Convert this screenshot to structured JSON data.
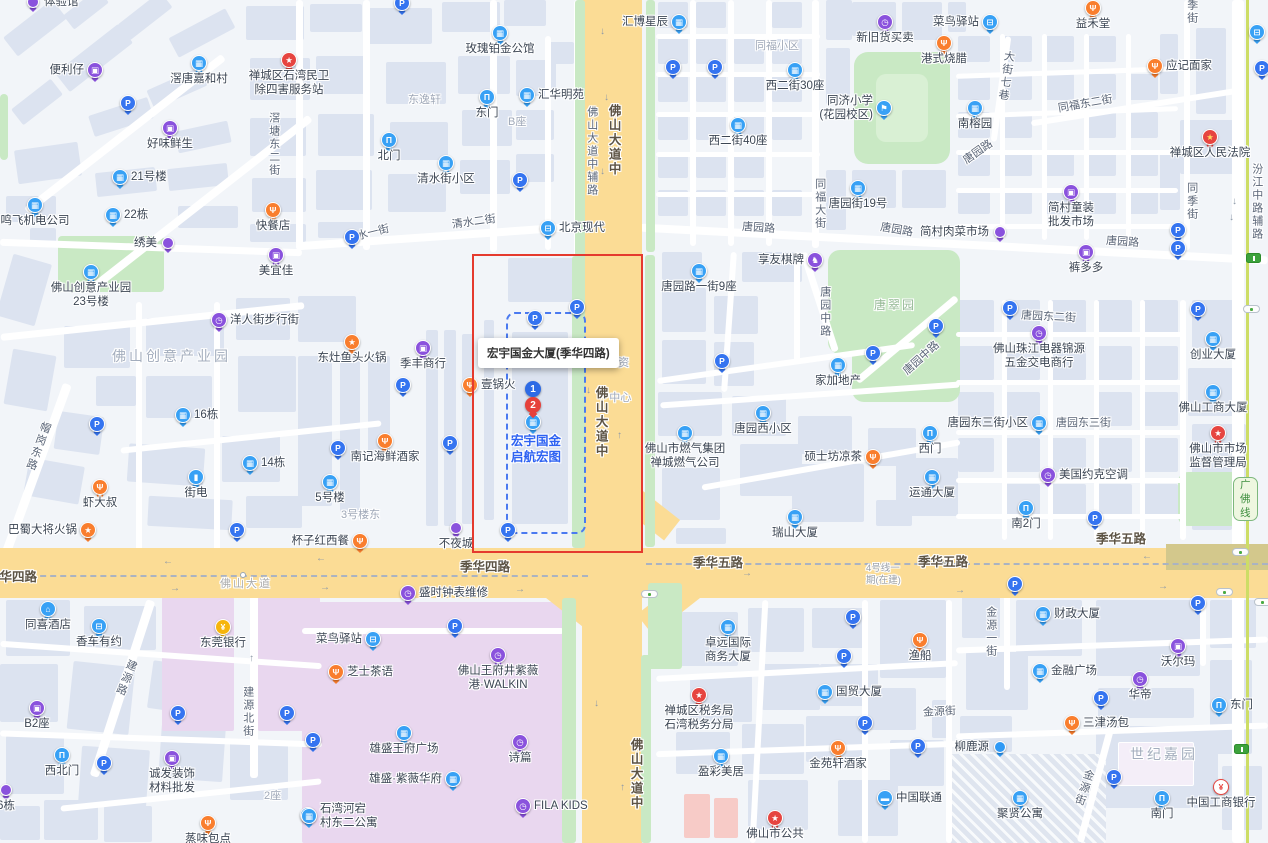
{
  "title": "宏宇国金大厦(季华四路) 地图",
  "colors": {
    "road_major": "#fbdc95",
    "road_minor": "#ffffff",
    "building": "#dce3f0",
    "green": "#c9e9c4",
    "mall": "#e9d7ef",
    "highlight_box": "#e53a2e",
    "parcel_dash": "#4b7af0",
    "poi_blue": "#38a1f5",
    "poi_parking": "#3574f0",
    "poi_purple": "#8a52dd",
    "poi_orange": "#f97e2e",
    "poi_red": "#e64540",
    "poi_yellow": "#f6b50c",
    "metro_line": "#cddd66",
    "poi_title_blue": "#2e62f2"
  },
  "highlight": {
    "box_label": "宏宇国金大厦(季华四路)",
    "marker_1": "1",
    "marker_2": "2",
    "poi_title_line1": "宏宇国金",
    "poi_title_line2": "启航宏图",
    "occluded_line1": "资",
    "occluded_line2": "中心"
  },
  "road_labels": [
    {
      "t": "滘塘东二街",
      "x": 266,
      "y": 112,
      "k": "street",
      "v": 1
    },
    {
      "t": "清水一街",
      "x": 346,
      "y": 228,
      "k": "street",
      "rot": -14
    },
    {
      "t": "清水二街",
      "x": 452,
      "y": 216,
      "k": "street",
      "rot": -8
    },
    {
      "t": "佛山大道中辅路",
      "x": 584,
      "y": 106,
      "k": "street",
      "v": 1
    },
    {
      "t": "佛山大道中",
      "x": 605,
      "y": 104,
      "k": "road",
      "v": 1
    },
    {
      "t": "佛山大道中",
      "x": 592,
      "y": 386,
      "k": "road",
      "v": 1
    },
    {
      "t": "佛山大道中",
      "x": 627,
      "y": 738,
      "k": "road",
      "v": 1
    },
    {
      "t": "东逸轩",
      "x": 408,
      "y": 94,
      "k": "area"
    },
    {
      "t": "B座",
      "x": 508,
      "y": 116,
      "k": "area"
    },
    {
      "t": "同福小区",
      "x": 755,
      "y": 40,
      "k": "area"
    },
    {
      "t": "同福大街",
      "x": 812,
      "y": 178,
      "k": "street",
      "v": 1
    },
    {
      "t": "唐园路",
      "x": 742,
      "y": 222,
      "k": "street",
      "rot": 4
    },
    {
      "t": "唐园路",
      "x": 880,
      "y": 224,
      "k": "street",
      "rot": 10
    },
    {
      "t": "唐园路",
      "x": 962,
      "y": 146,
      "k": "street",
      "rot": -35
    },
    {
      "t": "唐园路",
      "x": 1106,
      "y": 236,
      "k": "street",
      "rot": 4
    },
    {
      "t": "大街七巷",
      "x": 998,
      "y": 50,
      "k": "street",
      "v": 1,
      "rot": 8
    },
    {
      "t": "同福东二街",
      "x": 1058,
      "y": 98,
      "k": "street",
      "rot": -10
    },
    {
      "t": "同季街",
      "x": 1184,
      "y": -14,
      "k": "street",
      "v": 1
    },
    {
      "t": "同季街",
      "x": 1184,
      "y": 182,
      "k": "street",
      "v": 1
    },
    {
      "t": "汾江中路辅路",
      "x": 1249,
      "y": 163,
      "k": "street",
      "v": 1
    },
    {
      "t": "唐园中路",
      "x": 817,
      "y": 286,
      "k": "street",
      "v": 1
    },
    {
      "t": "唐园中路",
      "x": 900,
      "y": 352,
      "k": "street",
      "rot": -42
    },
    {
      "t": "唐翠园",
      "x": 874,
      "y": 298,
      "k": "park"
    },
    {
      "t": "唐园东二街",
      "x": 1021,
      "y": 311,
      "k": "street",
      "rot": 3
    },
    {
      "t": "唐园东三街",
      "x": 1056,
      "y": 417,
      "k": "street"
    },
    {
      "t": "帽岗东路",
      "x": 30,
      "y": 420,
      "k": "street",
      "v": 1,
      "rot": 20
    },
    {
      "t": "佛山创意产业园",
      "x": 112,
      "y": 348,
      "k": "area-lg"
    },
    {
      "t": "3号楼东",
      "x": 341,
      "y": 509,
      "k": "area"
    },
    {
      "t": "季华四路",
      "x": -13,
      "y": 570,
      "k": "road"
    },
    {
      "t": "佛山大道",
      "x": 220,
      "y": 578,
      "k": "boundary"
    },
    {
      "t": "季华四路",
      "x": 460,
      "y": 560,
      "k": "road"
    },
    {
      "t": "季华五路",
      "x": 693,
      "y": 556,
      "k": "road"
    },
    {
      "t": "季华五路",
      "x": 918,
      "y": 555,
      "k": "road"
    },
    {
      "t": "季华五路",
      "x": 1096,
      "y": 532,
      "k": "road"
    },
    {
      "t": "4号线一\n期(在建)",
      "x": 866,
      "y": 563,
      "k": "constr"
    },
    {
      "t": "金源街",
      "x": 923,
      "y": 706,
      "k": "street",
      "rot": -3
    },
    {
      "t": "金源街",
      "x": 1076,
      "y": 768,
      "k": "street",
      "v": 1,
      "rot": 18
    },
    {
      "t": "金源一街",
      "x": 983,
      "y": 606,
      "k": "street",
      "v": 1
    },
    {
      "t": "建源路",
      "x": 118,
      "y": 658,
      "k": "street",
      "v": 1,
      "rot": 22
    },
    {
      "t": "建源北街",
      "x": 240,
      "y": 686,
      "k": "street",
      "v": 1
    },
    {
      "t": "世纪嘉园",
      "x": 1130,
      "y": 746,
      "k": "area-lg"
    },
    {
      "t": "2座",
      "x": 264,
      "y": 790,
      "k": "area"
    }
  ],
  "pois": [
    {
      "t": "drop-p",
      "x": 33,
      "y": 2,
      "l": "体验馆",
      "lp": "r"
    },
    {
      "t": "shop",
      "x": 95,
      "y": 70,
      "l": "便利仔",
      "lp": "l"
    },
    {
      "t": "bld",
      "x": 199,
      "y": 63,
      "l": "滘唐嘉和村",
      "lp": "b"
    },
    {
      "t": "star-r",
      "x": 289,
      "y": 60,
      "l": "禅城区石湾民卫",
      "l2": "除四害服务站",
      "lp": "b"
    },
    {
      "t": "p",
      "x": 128,
      "y": 103
    },
    {
      "t": "shop",
      "x": 170,
      "y": 128,
      "l": "好味鲜生",
      "lp": "b"
    },
    {
      "t": "bld",
      "x": 120,
      "y": 177,
      "l": "21号楼",
      "lp": "r"
    },
    {
      "t": "bld",
      "x": 35,
      "y": 205,
      "l": "鸣飞机电公司",
      "lp": "b"
    },
    {
      "t": "bld",
      "x": 113,
      "y": 215,
      "l": "22栋",
      "lp": "r"
    },
    {
      "t": "food",
      "x": 273,
      "y": 210,
      "l": "快餐店",
      "lp": "b"
    },
    {
      "t": "drop-p",
      "x": 168,
      "y": 243,
      "l": "绣美",
      "lp": "l"
    },
    {
      "t": "shop",
      "x": 276,
      "y": 255,
      "l": "美宜佳",
      "lp": "b"
    },
    {
      "t": "bld",
      "x": 91,
      "y": 272,
      "l": "佛山创意产业园",
      "l2": "23号楼",
      "lp": "b"
    },
    {
      "t": "clk",
      "x": 219,
      "y": 320,
      "l": "洋人街步行街",
      "lp": "r"
    },
    {
      "t": "bld",
      "x": 183,
      "y": 415,
      "l": "16栋",
      "lp": "r"
    },
    {
      "t": "p",
      "x": 97,
      "y": 424
    },
    {
      "t": "batt",
      "x": 196,
      "y": 477,
      "l": "街电",
      "lp": "b"
    },
    {
      "t": "bld",
      "x": 250,
      "y": 463,
      "l": "14栋",
      "lp": "r"
    },
    {
      "t": "food",
      "x": 100,
      "y": 487,
      "l": "虾大叔",
      "lp": "b"
    },
    {
      "t": "star-o",
      "x": 88,
      "y": 530,
      "l": "巴蜀大将火锅",
      "lp": "l"
    },
    {
      "t": "p",
      "x": 237,
      "y": 530
    },
    {
      "t": "p",
      "x": 402,
      "y": 3
    },
    {
      "t": "bld",
      "x": 500,
      "y": 33,
      "l": "玫瑰铂金公馆",
      "lp": "b"
    },
    {
      "t": "gate",
      "x": 487,
      "y": 97,
      "l": "东门",
      "lp": "b"
    },
    {
      "t": "bld",
      "x": 527,
      "y": 95,
      "l": "汇华明苑",
      "lp": "r"
    },
    {
      "t": "gate",
      "x": 389,
      "y": 140,
      "l": "北门",
      "lp": "b"
    },
    {
      "t": "bld",
      "x": 446,
      "y": 163,
      "l": "清水街小区",
      "lp": "b"
    },
    {
      "t": "p",
      "x": 520,
      "y": 180
    },
    {
      "t": "p",
      "x": 352,
      "y": 237
    },
    {
      "t": "car",
      "x": 548,
      "y": 228,
      "l": "北京现代",
      "lp": "r"
    },
    {
      "t": "bld",
      "x": 679,
      "y": 22,
      "l": "汇博星辰",
      "lp": "l"
    },
    {
      "t": "clk",
      "x": 885,
      "y": 22,
      "l": "新旧货买卖",
      "lp": "b"
    },
    {
      "t": "food",
      "x": 944,
      "y": 43,
      "l": "港式烧腊",
      "lp": "b"
    },
    {
      "t": "p",
      "x": 673,
      "y": 67
    },
    {
      "t": "p",
      "x": 715,
      "y": 67
    },
    {
      "t": "bld",
      "x": 795,
      "y": 70,
      "l": "西二街30座",
      "lp": "b"
    },
    {
      "t": "school",
      "x": 884,
      "y": 108,
      "l": "同济小学",
      "l2": "(花园校区)",
      "lp": "l"
    },
    {
      "t": "bld",
      "x": 738,
      "y": 125,
      "l": "西二街40座",
      "lp": "b"
    },
    {
      "t": "bld",
      "x": 858,
      "y": 188,
      "l": "唐园街19号",
      "lp": "b"
    },
    {
      "t": "bus",
      "x": 990,
      "y": 22,
      "l": "菜鸟驿站",
      "lp": "l"
    },
    {
      "t": "food",
      "x": 1093,
      "y": 8,
      "l": "益禾堂",
      "lp": "b"
    },
    {
      "t": "food",
      "x": 1155,
      "y": 66,
      "l": "应记面家",
      "lp": "r"
    },
    {
      "t": "bld",
      "x": 975,
      "y": 108,
      "l": "南榕园",
      "lp": "b"
    },
    {
      "t": "govt",
      "x": 1210,
      "y": 137,
      "l": "禅城区人民法院",
      "lp": "b"
    },
    {
      "t": "shop",
      "x": 1071,
      "y": 192,
      "l": "简村童装",
      "l2": "批发市场",
      "lp": "b"
    },
    {
      "t": "drop-p",
      "x": 1000,
      "y": 232,
      "l": "简村肉菜市场",
      "lp": "l"
    },
    {
      "t": "p",
      "x": 1178,
      "y": 230
    },
    {
      "t": "p",
      "x": 1178,
      "y": 248
    },
    {
      "t": "bus",
      "x": 1257,
      "y": 32
    },
    {
      "t": "p",
      "x": 1262,
      "y": 68
    },
    {
      "t": "star-o",
      "x": 352,
      "y": 342,
      "l": "东灶鱼头火锅",
      "lp": "b"
    },
    {
      "t": "shop",
      "x": 423,
      "y": 348,
      "l": "季丰商行",
      "lp": "b"
    },
    {
      "t": "p",
      "x": 403,
      "y": 385
    },
    {
      "t": "food",
      "x": 470,
      "y": 385,
      "l": "壹锅火",
      "lp": "r"
    },
    {
      "t": "food",
      "x": 385,
      "y": 441,
      "l": "南记海鲜酒家",
      "lp": "b"
    },
    {
      "t": "p",
      "x": 338,
      "y": 448
    },
    {
      "t": "p",
      "x": 450,
      "y": 443
    },
    {
      "t": "bld",
      "x": 330,
      "y": 482,
      "l": "5号楼",
      "lp": "b"
    },
    {
      "t": "food",
      "x": 360,
      "y": 541,
      "l": "杯子红西餐",
      "lp": "l"
    },
    {
      "t": "drop-p",
      "x": 456,
      "y": 528,
      "l": "不夜城",
      "lp": "b"
    },
    {
      "t": "p",
      "x": 508,
      "y": 530
    },
    {
      "t": "p",
      "x": 535,
      "y": 318
    },
    {
      "t": "p",
      "x": 577,
      "y": 307
    },
    {
      "t": "knight",
      "x": 815,
      "y": 260,
      "l": "享友棋牌",
      "lp": "l"
    },
    {
      "t": "bld",
      "x": 699,
      "y": 271,
      "l": "唐园路一街9座",
      "lp": "b"
    },
    {
      "t": "p",
      "x": 936,
      "y": 326
    },
    {
      "t": "p",
      "x": 873,
      "y": 353
    },
    {
      "t": "p",
      "x": 722,
      "y": 361
    },
    {
      "t": "bld",
      "x": 838,
      "y": 365,
      "l": "家加地产",
      "lp": "b"
    },
    {
      "t": "bld",
      "x": 763,
      "y": 413,
      "l": "唐园西小区",
      "lp": "b"
    },
    {
      "t": "bld",
      "x": 685,
      "y": 433,
      "l": "佛山市燃气集团",
      "l2": "禅城燃气公司",
      "lp": "b"
    },
    {
      "t": "food",
      "x": 873,
      "y": 457,
      "l": "硕士坊凉茶",
      "lp": "l"
    },
    {
      "t": "gate",
      "x": 930,
      "y": 433,
      "l": "西门",
      "lp": "b"
    },
    {
      "t": "bld",
      "x": 932,
      "y": 477,
      "l": "运通大厦",
      "lp": "b"
    },
    {
      "t": "bld",
      "x": 795,
      "y": 517,
      "l": "瑞山大厦",
      "lp": "b"
    },
    {
      "t": "shop",
      "x": 1086,
      "y": 252,
      "l": "裤多多",
      "lp": "b"
    },
    {
      "t": "p",
      "x": 1010,
      "y": 308
    },
    {
      "t": "clk",
      "x": 1039,
      "y": 333,
      "l": "佛山珠江电器锦源",
      "l2": "五金交电商行",
      "lp": "b"
    },
    {
      "t": "bld",
      "x": 1213,
      "y": 339,
      "l": "创业大厦",
      "lp": "b"
    },
    {
      "t": "p",
      "x": 1198,
      "y": 309
    },
    {
      "t": "bld",
      "x": 1213,
      "y": 392,
      "l": "佛山工商大厦",
      "lp": "b"
    },
    {
      "t": "bld",
      "x": 1039,
      "y": 423,
      "l": "唐园东三街小区",
      "lp": "l"
    },
    {
      "t": "star-r",
      "x": 1218,
      "y": 433,
      "l": "佛山市市场",
      "l2": "监督管理局",
      "lp": "b"
    },
    {
      "t": "clk",
      "x": 1048,
      "y": 475,
      "l": "美国约克空调",
      "lp": "r"
    },
    {
      "t": "gate",
      "x": 1026,
      "y": 508,
      "l": "南2门",
      "lp": "b"
    },
    {
      "t": "p",
      "x": 1095,
      "y": 518
    },
    {
      "t": "hotel",
      "x": 48,
      "y": 609,
      "l": "同喜酒店",
      "lp": "b"
    },
    {
      "t": "car",
      "x": 99,
      "y": 626,
      "l": "香车有约",
      "lp": "b"
    },
    {
      "t": "bank",
      "x": 223,
      "y": 627,
      "l": "东莞银行",
      "lp": "b"
    },
    {
      "t": "shop",
      "x": 37,
      "y": 708,
      "l": "B2座",
      "lp": "b"
    },
    {
      "t": "p",
      "x": 178,
      "y": 713
    },
    {
      "t": "p",
      "x": 287,
      "y": 713
    },
    {
      "t": "gate",
      "x": 62,
      "y": 755,
      "l": "西北门",
      "lp": "b"
    },
    {
      "t": "p",
      "x": 104,
      "y": 763
    },
    {
      "t": "shop",
      "x": 172,
      "y": 758,
      "l": "诚发装饰",
      "l2": "材料批发",
      "lp": "b"
    },
    {
      "t": "drop-p",
      "x": 6,
      "y": 790,
      "l": "6栋",
      "lp": "b"
    },
    {
      "t": "food",
      "x": 208,
      "y": 823,
      "l": "蒸味包点",
      "lp": "b"
    },
    {
      "t": "bus",
      "x": 308,
      "y": 815
    },
    {
      "t": "clk",
      "x": 408,
      "y": 593,
      "l": "盛时钟表维修",
      "lp": "r"
    },
    {
      "t": "p",
      "x": 455,
      "y": 626
    },
    {
      "t": "truck",
      "x": 373,
      "y": 639,
      "l": "菜鸟驿站",
      "lp": "l"
    },
    {
      "t": "food",
      "x": 336,
      "y": 672,
      "l": "芝士茶语",
      "lp": "r"
    },
    {
      "t": "clk",
      "x": 498,
      "y": 655,
      "l": "佛山王府井紫薇",
      "l2": "港·WALKIN",
      "lp": "b"
    },
    {
      "t": "bld",
      "x": 404,
      "y": 733,
      "l": "雄盛王府广场",
      "lp": "b"
    },
    {
      "t": "clk",
      "x": 520,
      "y": 742,
      "l": "诗篇",
      "lp": "b"
    },
    {
      "t": "bld",
      "x": 453,
      "y": 779,
      "l": "雄盛·紫薇华府",
      "lp": "l"
    },
    {
      "t": "bld",
      "x": 309,
      "y": 816,
      "l": "石湾河宕",
      "l2": "村东二公寓",
      "lp": "r"
    },
    {
      "t": "clk",
      "x": 523,
      "y": 806,
      "l": "FILA KIDS",
      "lp": "r"
    },
    {
      "t": "p",
      "x": 313,
      "y": 740
    },
    {
      "t": "bld",
      "x": 728,
      "y": 627,
      "l": "卓远国际",
      "l2": "商务大厦",
      "lp": "b"
    },
    {
      "t": "p",
      "x": 853,
      "y": 617
    },
    {
      "t": "p",
      "x": 844,
      "y": 656
    },
    {
      "t": "food",
      "x": 920,
      "y": 640,
      "l": "渔船",
      "lp": "b"
    },
    {
      "t": "bld",
      "x": 825,
      "y": 692,
      "l": "国贸大厦",
      "lp": "r"
    },
    {
      "t": "star-r",
      "x": 699,
      "y": 695,
      "l": "禅城区税务局",
      "l2": "石湾税务分局",
      "lp": "b"
    },
    {
      "t": "p",
      "x": 865,
      "y": 723
    },
    {
      "t": "food",
      "x": 838,
      "y": 748,
      "l": "金苑轩酒家",
      "lp": "b"
    },
    {
      "t": "p",
      "x": 918,
      "y": 746
    },
    {
      "t": "bld",
      "x": 721,
      "y": 756,
      "l": "盈彩美居",
      "lp": "b"
    },
    {
      "t": "card",
      "x": 885,
      "y": 798,
      "l": "中国联通",
      "lp": "r"
    },
    {
      "t": "star-r",
      "x": 775,
      "y": 818,
      "l": "佛山市公共",
      "lp": "b"
    },
    {
      "t": "p",
      "x": 1015,
      "y": 584
    },
    {
      "t": "bld",
      "x": 1043,
      "y": 614,
      "l": "财政大厦",
      "lp": "r"
    },
    {
      "t": "p",
      "x": 1198,
      "y": 603
    },
    {
      "t": "shop",
      "x": 1178,
      "y": 646,
      "l": "沃尔玛",
      "lp": "b"
    },
    {
      "t": "bld",
      "x": 1040,
      "y": 671,
      "l": "金融广场",
      "lp": "r"
    },
    {
      "t": "clk",
      "x": 1140,
      "y": 679,
      "l": "华帝",
      "lp": "b"
    },
    {
      "t": "p",
      "x": 1101,
      "y": 698
    },
    {
      "t": "gate",
      "x": 1219,
      "y": 705,
      "l": "东门",
      "lp": "r"
    },
    {
      "t": "food",
      "x": 1072,
      "y": 723,
      "l": "三津汤包",
      "lp": "r"
    },
    {
      "t": "drop-b",
      "x": 1000,
      "y": 747,
      "l": "柳鹿源",
      "lp": "l"
    },
    {
      "t": "p",
      "x": 1114,
      "y": 777
    },
    {
      "t": "bld",
      "x": 1020,
      "y": 798,
      "l": "聚贤公寓",
      "lp": "b"
    },
    {
      "t": "gate",
      "x": 1162,
      "y": 798,
      "l": "南门",
      "lp": "b"
    },
    {
      "t": "icbc",
      "x": 1221,
      "y": 787,
      "l": "中国工商银行",
      "lp": "b"
    }
  ],
  "decor": {
    "metro_badge": {
      "t": "广佛线",
      "x": 1233,
      "y": 477
    },
    "traffic_lights": [
      [
        649,
        594
      ],
      [
        1224,
        592
      ],
      [
        1262,
        602
      ],
      [
        1251,
        309
      ],
      [
        1240,
        552
      ]
    ],
    "metro_stations": [
      [
        1253,
        258
      ],
      [
        1241,
        749
      ]
    ],
    "arrows": [
      {
        "g": "←",
        "x": 163,
        "y": 556
      },
      {
        "g": "→",
        "x": 170,
        "y": 583
      },
      {
        "g": "←",
        "x": 316,
        "y": 553
      },
      {
        "g": "→",
        "x": 320,
        "y": 582
      },
      {
        "g": "←",
        "x": 498,
        "y": 555
      },
      {
        "g": "→",
        "x": 515,
        "y": 584
      },
      {
        "g": "←",
        "x": 940,
        "y": 556
      },
      {
        "g": "→",
        "x": 955,
        "y": 585
      },
      {
        "g": "←",
        "x": 1142,
        "y": 551
      },
      {
        "g": "→",
        "x": 1158,
        "y": 581
      },
      {
        "g": "→",
        "x": 742,
        "y": 568
      },
      {
        "g": "↓",
        "x": 600,
        "y": 26
      },
      {
        "g": "↓",
        "x": 604,
        "y": 92
      },
      {
        "g": "↓",
        "x": 600,
        "y": 166
      },
      {
        "g": "↓",
        "x": 586,
        "y": 385
      },
      {
        "g": "↑",
        "x": 617,
        "y": 430
      },
      {
        "g": "↓",
        "x": 594,
        "y": 698
      },
      {
        "g": "↑",
        "x": 620,
        "y": 782
      },
      {
        "g": "↓",
        "x": 1232,
        "y": 196
      },
      {
        "g": "↓",
        "x": 1229,
        "y": 212
      },
      {
        "g": "↑",
        "x": 249,
        "y": 653
      }
    ]
  }
}
